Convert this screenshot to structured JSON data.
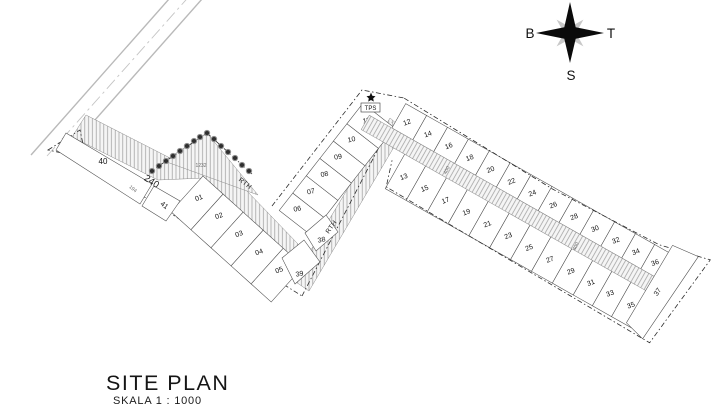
{
  "title_block": {
    "title": "SITE PLAN",
    "scale_label": "SKALA  1 : 1000"
  },
  "compass": {
    "west_label": "B",
    "east_label": "T",
    "south_label": "S"
  },
  "plan": {
    "left_block": {
      "lower_row_lots": [
        "01",
        "02",
        "03",
        "04",
        "05"
      ],
      "upper_row_lots": [
        "06",
        "07",
        "08",
        "09",
        "10",
        "11"
      ],
      "corner_lot_upper": "38",
      "corner_lot_lower": "39",
      "west_lot_large": "40",
      "west_lot_small": "41",
      "greenway_label_1": "RTH",
      "greenway_label_2": "RTH",
      "facility_label": "TPS",
      "dim_strip": "240",
      "dim_boundary": "194",
      "dim_area": "1232"
    },
    "right_block": {
      "north_row_lots": [
        "12",
        "14",
        "16",
        "18",
        "20",
        "22",
        "24",
        "26",
        "28",
        "30",
        "32",
        "34",
        "36"
      ],
      "south_row_lots": [
        "13",
        "15",
        "17",
        "19",
        "21",
        "23",
        "25",
        "27",
        "29",
        "31",
        "33",
        "35"
      ],
      "east_end_lot": "37",
      "road_dim_1": "400",
      "road_dim_2": "400"
    }
  },
  "colors": {
    "background": "#ffffff",
    "linework": "#2b2b2b",
    "hatch": "#9a9a9a",
    "strip_fill": "#f5f5f5",
    "road_gray": "#b9b9b9",
    "text": "#111111",
    "dim_text": "#6a6a6a"
  }
}
